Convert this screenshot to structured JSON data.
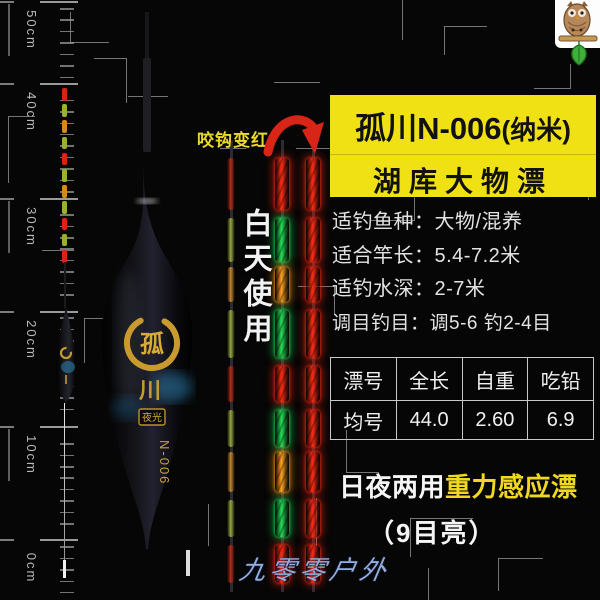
{
  "page": {
    "bg": "#060606"
  },
  "logo": {
    "name": "owl-mascot"
  },
  "ruler": {
    "unit_labels": [
      "50cm",
      "40cm",
      "30cm",
      "20cm",
      "10cm",
      "0cm"
    ]
  },
  "callouts": {
    "bite_alert": "咬钩变红",
    "day_use_vertical": "白天使用"
  },
  "header": {
    "title_main": "孤川N-006",
    "title_paren": "(纳米)",
    "subtitle": "湖库大物漂"
  },
  "specs": {
    "lines": [
      "适钓鱼种：大物/混养",
      "适合竿长：5.4-7.2米",
      "适钓水深：2-7米",
      "调目钓目：调5-6 钓2-4目"
    ]
  },
  "spec_table": {
    "headers": [
      "漂号",
      "全长",
      "自重",
      "吃铅"
    ],
    "rows": [
      [
        "均号",
        "44.0",
        "2.60",
        "6.9"
      ]
    ]
  },
  "footer": {
    "feature_white": "日夜两用",
    "feature_yellow": "重力感应漂",
    "bright_note": "（9目亮）",
    "watermark": "九零零户外"
  },
  "float_art": {
    "brand_top": "孤",
    "brand_bottom": "川",
    "seal_label": "夜光",
    "model_code": "N-006"
  },
  "led": {
    "day_unlit": [
      "red",
      "yellowgreen",
      "orange",
      "yellowgreen",
      "red",
      "yellowgreen",
      "orange",
      "yellowgreen",
      "red"
    ],
    "day_lit": [
      "red",
      "green",
      "orange",
      "green",
      "red",
      "green",
      "orange",
      "green",
      "red"
    ],
    "night_lit": [
      "red",
      "red",
      "red",
      "red",
      "red",
      "red",
      "red",
      "red",
      "red"
    ],
    "mini": [
      "red",
      "yellowgreen",
      "orange",
      "yellowgreen",
      "red",
      "yellowgreen",
      "orange",
      "yellowgreen",
      "red",
      "yellowgreen",
      "red"
    ]
  },
  "colors": {
    "title_bg": "#f0e114",
    "bite_text": "#e9d92e",
    "arrow_red": "#d92518",
    "feature_yellow": "#f0d822",
    "watermark_blue": "#93aedd",
    "led": {
      "red": "#ff2a14",
      "green": "#22dd55",
      "orange": "#ffa01e",
      "yellowgreen": "#b8cf35"
    }
  }
}
